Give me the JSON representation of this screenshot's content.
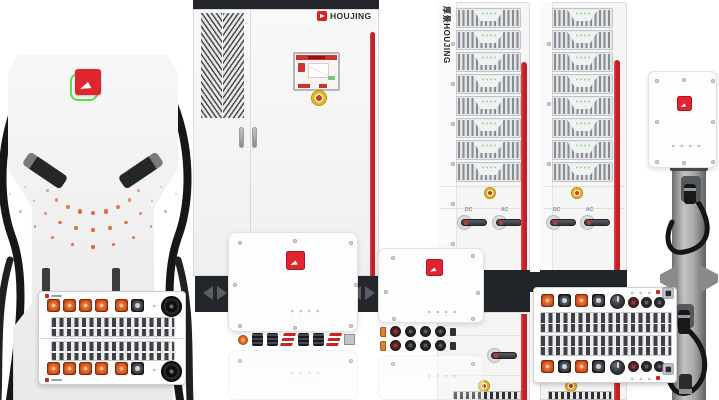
{
  "brand": {
    "cabinet_logo": "HOUJING",
    "tower_vertical_logo": "厚景HOUJING"
  },
  "tower": {
    "dc_switch_label": "DC",
    "ac_switch_label": "AC"
  },
  "colors": {
    "accent_stripe_red": "#c41e28",
    "logo_red": "#e02430",
    "logo_green_outline": "#5ae04e",
    "connector_orange": "#e06227",
    "led_green": "#8ad08a",
    "emergency_button_yellow": "#e6b81c",
    "emergency_button_red": "#d23a2c",
    "dark_panel": "#23262a",
    "body_white": "#f6f6f6"
  }
}
